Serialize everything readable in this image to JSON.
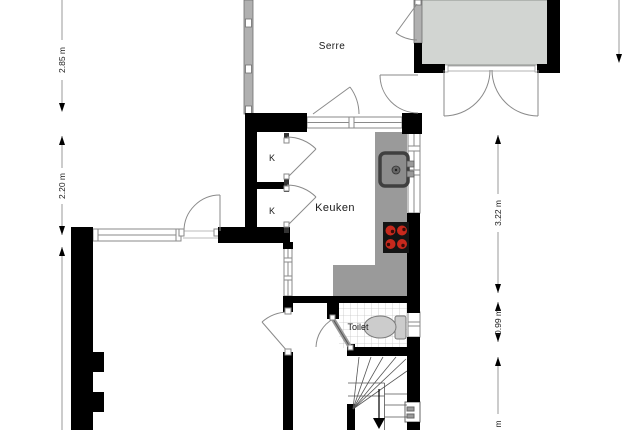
{
  "plan": {
    "type": "floor-plan",
    "rooms": {
      "serre": "Serre",
      "kitchen": "Keuken",
      "closet_top": "K",
      "closet_bottom": "K",
      "toilet": "Toilet"
    },
    "dimensions": {
      "left_upper": "2.85 m",
      "left_middle": "2.20 m",
      "right_upper": "3.22 m",
      "right_middle": "0.99 m",
      "right_lower_partial": "m"
    },
    "colors": {
      "wall": "#000000",
      "glass_wall": "#b0b0b0",
      "annex_fill": "#d2d5d2",
      "counter": "#9a9a9a",
      "sink_frame": "#3f3f3f",
      "sink_inner": "#8c8c8c",
      "stove_pad": "#141414",
      "burner": "#c7291d",
      "fixture_fill": "#cccccc",
      "door_line": "#8a8a8a",
      "stair_line": "#555555",
      "dimension_line": "#9a9a9a",
      "dimension_arrow": "#000000"
    }
  }
}
